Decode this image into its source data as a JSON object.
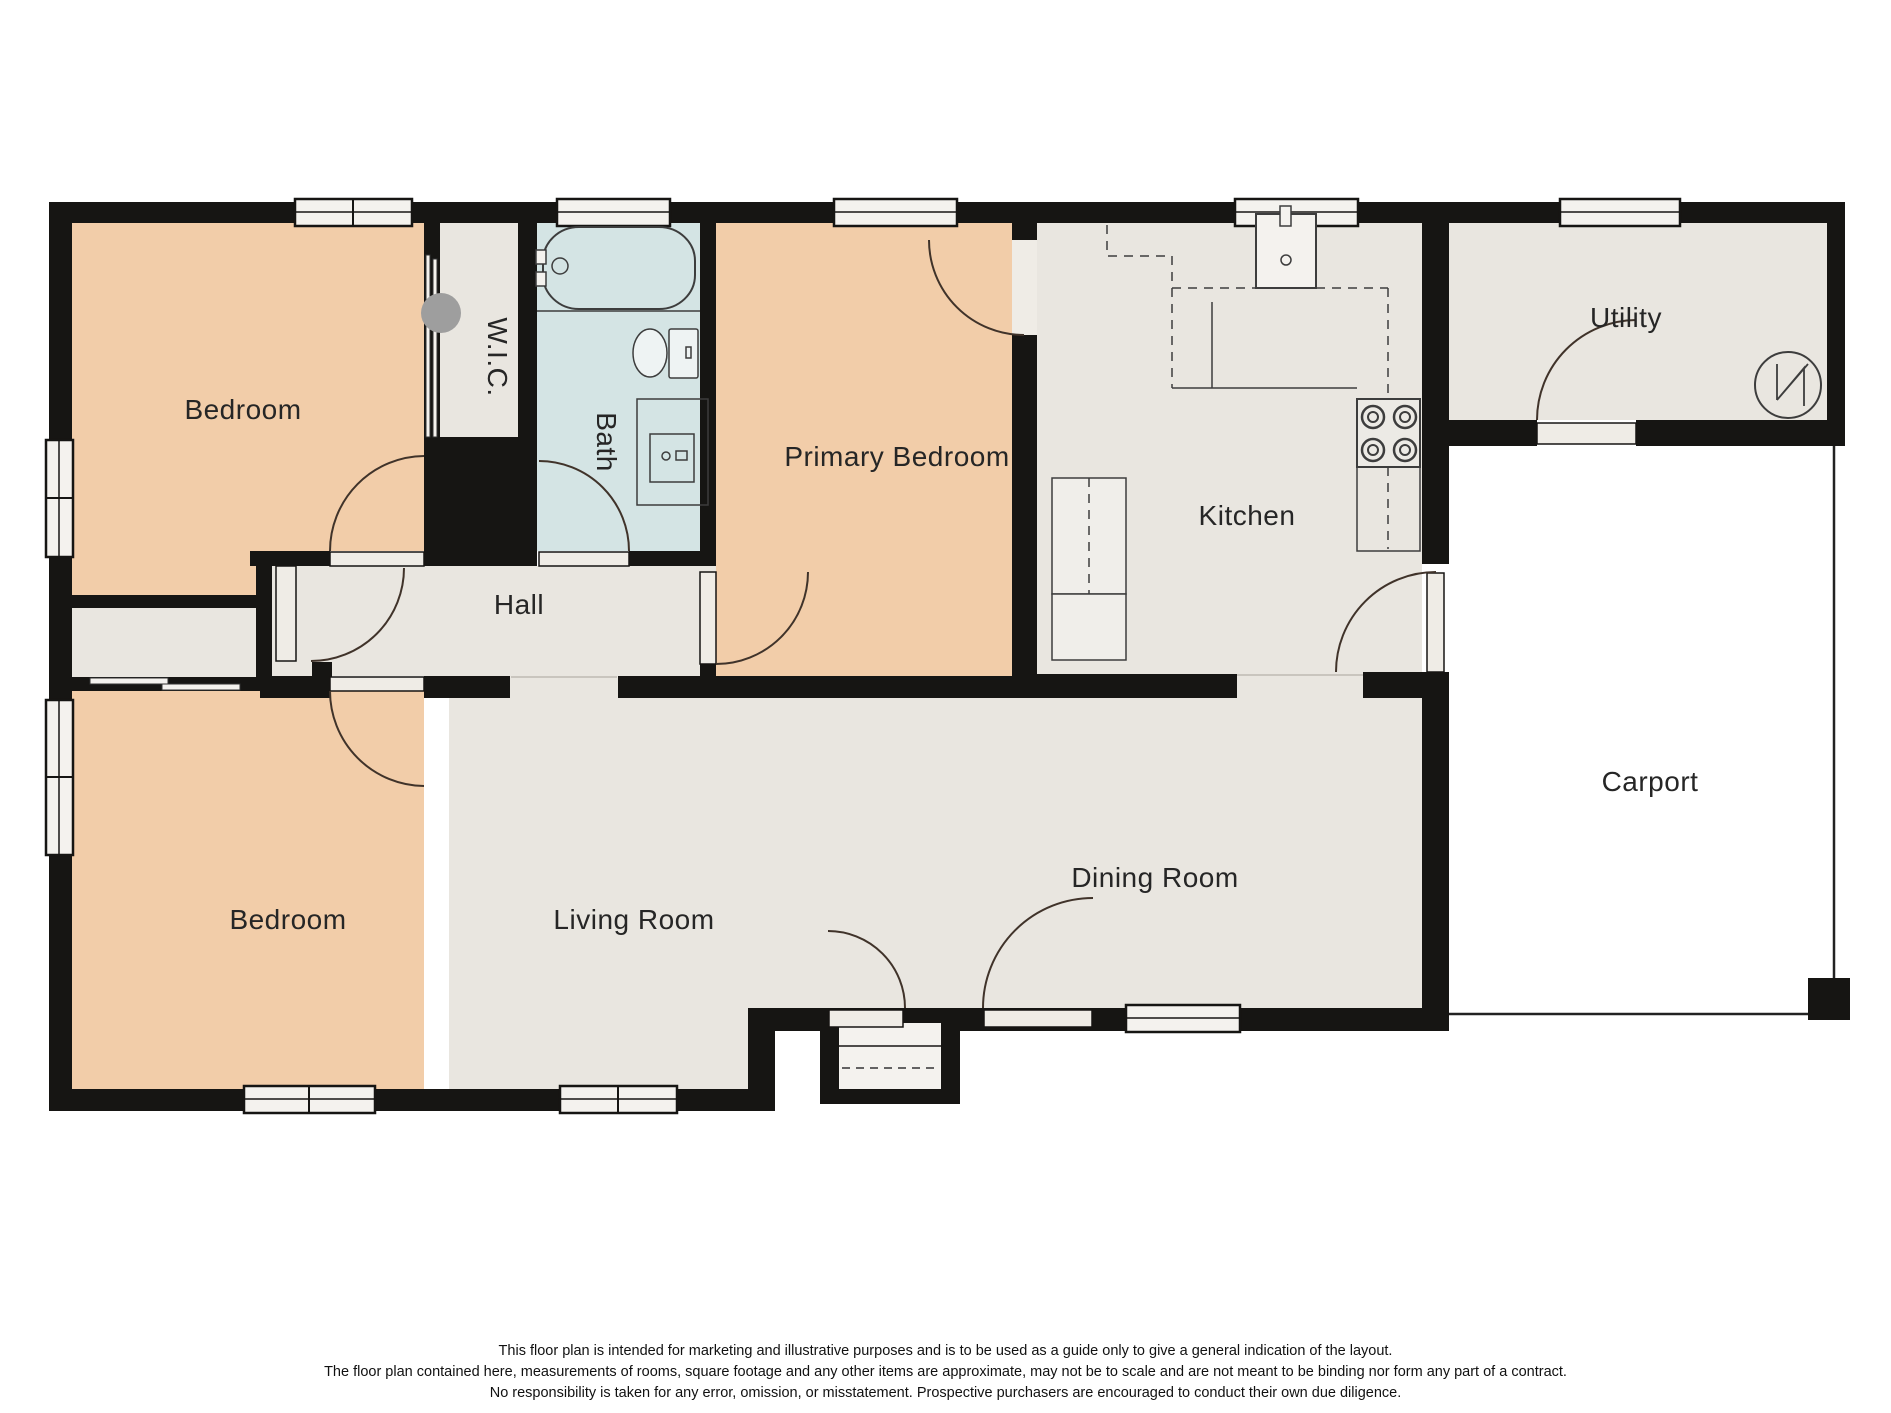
{
  "rooms": {
    "bedroom_top": "Bedroom",
    "wic": "W.I.C.",
    "bath": "Bath",
    "primary_bedroom": "Primary Bedroom",
    "kitchen": "Kitchen",
    "utility": "Utility",
    "hall": "Hall",
    "bedroom_bottom": "Bedroom",
    "living_room": "Living Room",
    "dining_room": "Dining Room",
    "carport": "Carport"
  },
  "disclaimer": {
    "line1": "This floor plan is intended for marketing and illustrative purposes and is to be used as a guide only to give a general indication of the layout.",
    "line2": "The floor plan contained here, measurements of rooms, square footage and any other items are approximate, may not be to scale and are not meant to be binding nor form any part of a contract.",
    "line3": "No responsibility is taken for any error, omission, or misstatement. Prospective purchasers are encouraged to conduct their own due diligence."
  },
  "colors": {
    "wall": "#161513",
    "bedroom_fill": "#f2cda9",
    "floor_fill": "#e9e6e0",
    "bath_fill": "#d4e4e4",
    "window_fill": "#f4f2ee",
    "door_leaf_fill": "#efece6",
    "door_arc": "#40332a",
    "wic_door_dot": "#9e9e9e"
  },
  "icons": {
    "bathtub": "bathtub-icon",
    "toilet": "toilet-icon",
    "vanity_sink": "vanity-sink-icon",
    "kitchen_sink": "kitchen-sink-icon",
    "stove": "stove-icon",
    "water_heater": "water-heater-icon",
    "carport_post": "carport-post-icon"
  }
}
